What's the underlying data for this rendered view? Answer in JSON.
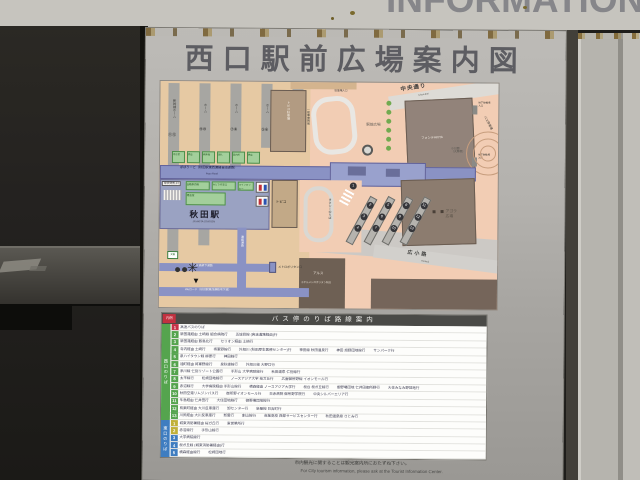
{
  "photo": {
    "wall_heading": "INFORMATION"
  },
  "sign": {
    "title": "西口駅前広場案内図",
    "map": {
      "streets": {
        "chuo": "中央通り",
        "chuo_en": "Chuo-dori",
        "hirokoji": "広小路",
        "hirokoji_en": "Hirokoji"
      },
      "platforms": {
        "shinkansen": "新幹線ホーム",
        "local": "ホーム",
        "numbers": [
          "⑪⑫",
          "⑨⑩",
          "⑦⑧",
          "⑤⑥",
          "③④"
        ]
      },
      "facilities_small": [
        "待合室",
        "売店",
        "券売機",
        "改札",
        "案内所",
        "売店"
      ],
      "facilities_green": [
        "自動券売機",
        "みどりの窓口",
        "コインロッカー"
      ],
      "waiting_room": "待合室",
      "central_gate": "中央改札口",
      "station_name": "秋田駅",
      "station_name_en": "JR AKITA STATION",
      "topico": "トピコ",
      "topico_parking": "トピコ駐車場",
      "popo_road": "ぽぽろーど（秋田駅東西連絡自由通路）",
      "popo_road_en": "Popo Road",
      "jr_passage": "ＪＲ高架下通路",
      "we_road": "Weロード（秋田駅東西連絡地下道）",
      "renraku_corridor": "連絡通路",
      "metropolitan_exit": "メトロポリタン口",
      "you_are_here": "◀現在地",
      "koban": "交番",
      "plaza": {
        "ekimae": "駅前広場",
        "agora1": "アゴラ",
        "agora2": "広場",
        "kokoen": "小公園",
        "kokoen_sub": "（大屋根）",
        "ippansha": "一般車乗降場",
        "parking_in": "駐車場入口",
        "bus_drop": "バス降車場",
        "bike1": "地下駐輪場",
        "bike2": "入口",
        "taxi": "タクシーのりば"
      },
      "buildings": {
        "fonte": "フォンテAKITA",
        "als": "アルス",
        "hotel": "ホテルメトロポリタン秋田"
      },
      "bus_stops": {
        "single": "1",
        "islands": [
          [
            "2",
            "3",
            "4"
          ],
          [
            "5",
            "6",
            "7"
          ],
          [
            "8",
            "9",
            "10"
          ],
          [
            "11",
            "12",
            "13"
          ]
        ]
      }
    },
    "bus_table": {
      "tag": "凡例",
      "header": "バス停のりば路線案内",
      "groups": [
        {
          "band": "西口のりば",
          "band_color": "#55a44e",
          "rows": [
            {
              "n": "1",
              "c": "#c63148",
              "segs": [
                "高速バスのりば"
              ]
            },
            {
              "n": "2",
              "c": "#55a44e",
              "segs": [
                "新国道経由 土崎線 組合病院行",
                "五城目線 (高速道路経由)行"
              ]
            },
            {
              "n": "3",
              "c": "#55a44e",
              "segs": [
                "新国道経由 飯島北行",
                "セリオン経由 土崎行"
              ]
            },
            {
              "n": "4",
              "c": "#55a44e",
              "segs": [
                "寺内経由 土崎行",
                "将軍野線行",
                "外旭川 (秋田厚生医療センター)行",
                "神田線 秋田温泉行",
                "神田 旭野団地線行",
                "サンパーク行"
              ]
            },
            {
              "n": "5",
              "c": "#55a44e",
              "segs": [
                "泉ハイタウン線 柳原行",
                "神田線行"
              ]
            },
            {
              "n": "6",
              "c": "#55a44e",
              "segs": [
                "通町経由 将軍野線行",
                "泉秋操線行",
                "外旭川線 大野口行"
              ]
            },
            {
              "n": "7",
              "c": "#55a44e",
              "segs": [
                "添川線 仁別リゾート公園行",
                "手形山 大学病院線行",
                "秋田温泉 仁別線行"
              ]
            },
            {
              "n": "8",
              "c": "#55a44e",
              "segs": [
                "太平線行",
                "松崎団地線行",
                "ノースアジア大学 桜ガ丘行",
                "広面御所野線 イオンモール行"
              ]
            },
            {
              "n": "9",
              "c": "#55a44e",
              "segs": [
                "赤沼線行",
                "大学病院経由 手形山線行",
                "横森経由 ノースアジア大学行",
                "桜台 桜ガ丘線行",
                "御野場団地 仁井田御所野行",
                "大住みなみ野団地行"
              ]
            },
            {
              "n": "10",
              "c": "#55a44e",
              "segs": [
                "秋田空港リムジンバス行",
                "御所野イオンモール行",
                "日赤病院 御所野学院行",
                "中央シルバーエリア行"
              ]
            },
            {
              "n": "11",
              "c": "#55a44e",
              "segs": [
                "牛島経由 仁井田行",
                "大住団地線行",
                "御野場団地線行"
              ]
            },
            {
              "n": "12",
              "c": "#55a44e",
              "segs": [
                "有楽町経由 大川反車庫行",
                "卸センター行",
                "新屋線 日吉町行"
              ]
            },
            {
              "n": "13",
              "c": "#55a44e",
              "segs": [
                "川尻経由 大川反車庫行",
                "新屋行",
                "割山線行",
                "商業高校 西部サービスセンター行",
                "秋田温泉線 さとみ行"
              ]
            }
          ]
        },
        {
          "band": "東口のりば",
          "band_color": "#3f7dc0",
          "rows": [
            {
              "n": "1",
              "c": "#c0b038",
              "segs": [
                "城東消防署経由 桜ガ丘行",
                "東営業所行"
              ]
            },
            {
              "n": "2",
              "c": "#c0b038",
              "segs": [
                "赤沼線行",
                "手形山線行"
              ]
            },
            {
              "n": "3",
              "c": "#3f7dc0",
              "segs": [
                "大学病院線行"
              ]
            },
            {
              "n": "4",
              "c": "#3f7dc0",
              "segs": [
                "桜ガ丘線 (城東消防署経由)行"
              ]
            },
            {
              "n": "5",
              "c": "#3f7dc0",
              "segs": [
                "横森経由線行",
                "松崎団地行"
              ]
            }
          ]
        }
      ]
    },
    "notes": {
      "jp": "市内観光に関することは観光案内所におたずね下さい。",
      "en": "For City tourism information, please ask at the Tourist Information Center."
    }
  }
}
